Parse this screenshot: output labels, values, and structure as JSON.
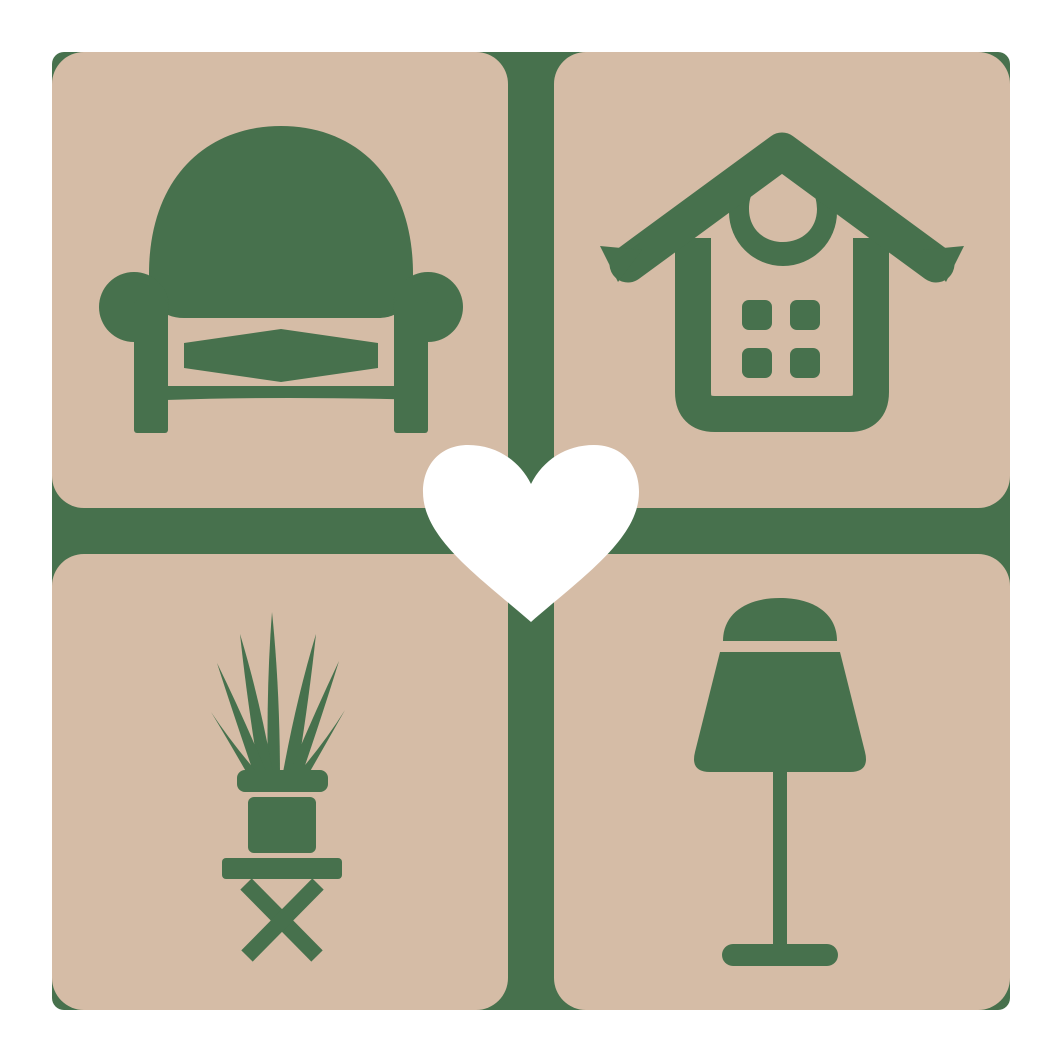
{
  "logo": {
    "name": "home-decor-logo",
    "colors": {
      "background": "#FFFFFF",
      "green": "#47714D",
      "tan": "#D5BCA6",
      "heart": "#FFFFFF"
    },
    "tiles": [
      {
        "position": "top-left",
        "icon": "armchair"
      },
      {
        "position": "top-right",
        "icon": "house"
      },
      {
        "position": "bottom-left",
        "icon": "potted-plant"
      },
      {
        "position": "bottom-right",
        "icon": "table-lamp"
      }
    ],
    "center": {
      "icon": "heart"
    }
  }
}
